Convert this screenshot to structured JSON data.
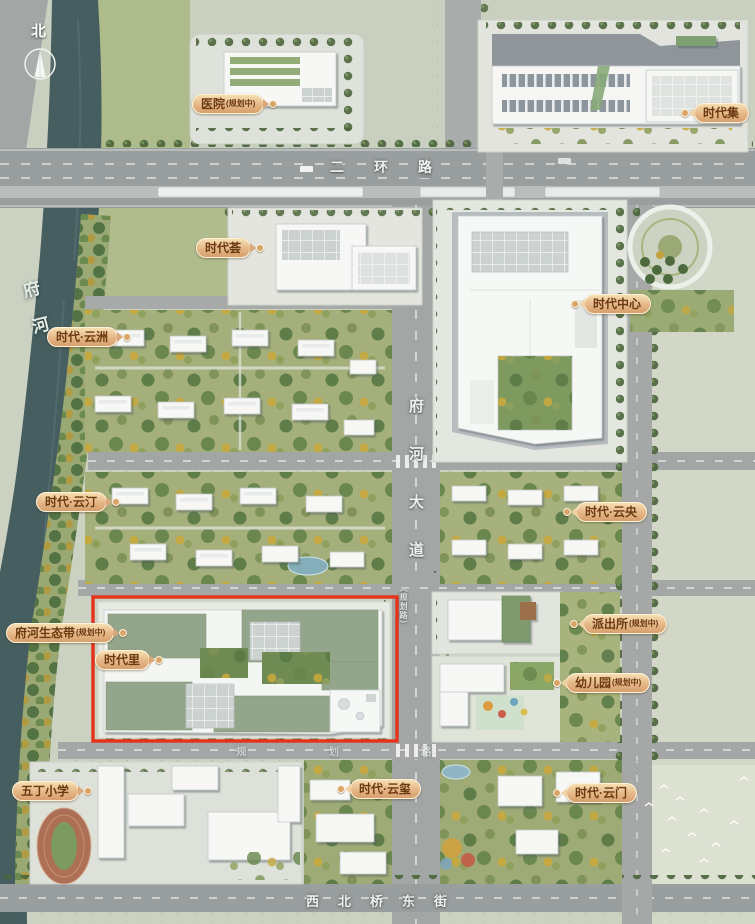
{
  "compass": {
    "north": "北"
  },
  "river": {
    "name": "府河"
  },
  "road_labels": {
    "ring_road": "二环路",
    "fuhe_avenue": "府河大道",
    "xibeiqiao_east": "西北桥东街",
    "planned_road": "规划路",
    "planned_road_side": "（规划路）"
  },
  "landmarks": {
    "hospital": {
      "text": "医院",
      "sub": "(规划中)"
    },
    "shidaiji": {
      "text": "时代集",
      "sub": ""
    },
    "shidaihui": {
      "text": "时代荟",
      "sub": ""
    },
    "shidaizhongxin": {
      "text": "时代中心",
      "sub": ""
    },
    "yunzhou": {
      "text": "时代·云洲",
      "sub": ""
    },
    "yunting": {
      "text": "时代·云汀",
      "sub": ""
    },
    "yunyang": {
      "text": "时代·云央",
      "sub": ""
    },
    "paichusuo": {
      "text": "派出所",
      "sub": "(规划中)"
    },
    "youeryuan": {
      "text": "幼儿园",
      "sub": "(规划中)"
    },
    "ecobelt": {
      "text": "府河生态带",
      "sub": "(规划中)"
    },
    "shidaili": {
      "text": "时代里",
      "sub": ""
    },
    "wudingschool": {
      "text": "五丁小学",
      "sub": ""
    },
    "yunxi": {
      "text": "时代·云玺",
      "sub": ""
    },
    "yunmen": {
      "text": "时代·云门",
      "sub": ""
    }
  },
  "colors": {
    "highlight_red": "#e6311b",
    "label_bg": "#e5b687",
    "label_text": "#6b3a10",
    "river": "#465e60",
    "land": "#ccd2c2"
  }
}
